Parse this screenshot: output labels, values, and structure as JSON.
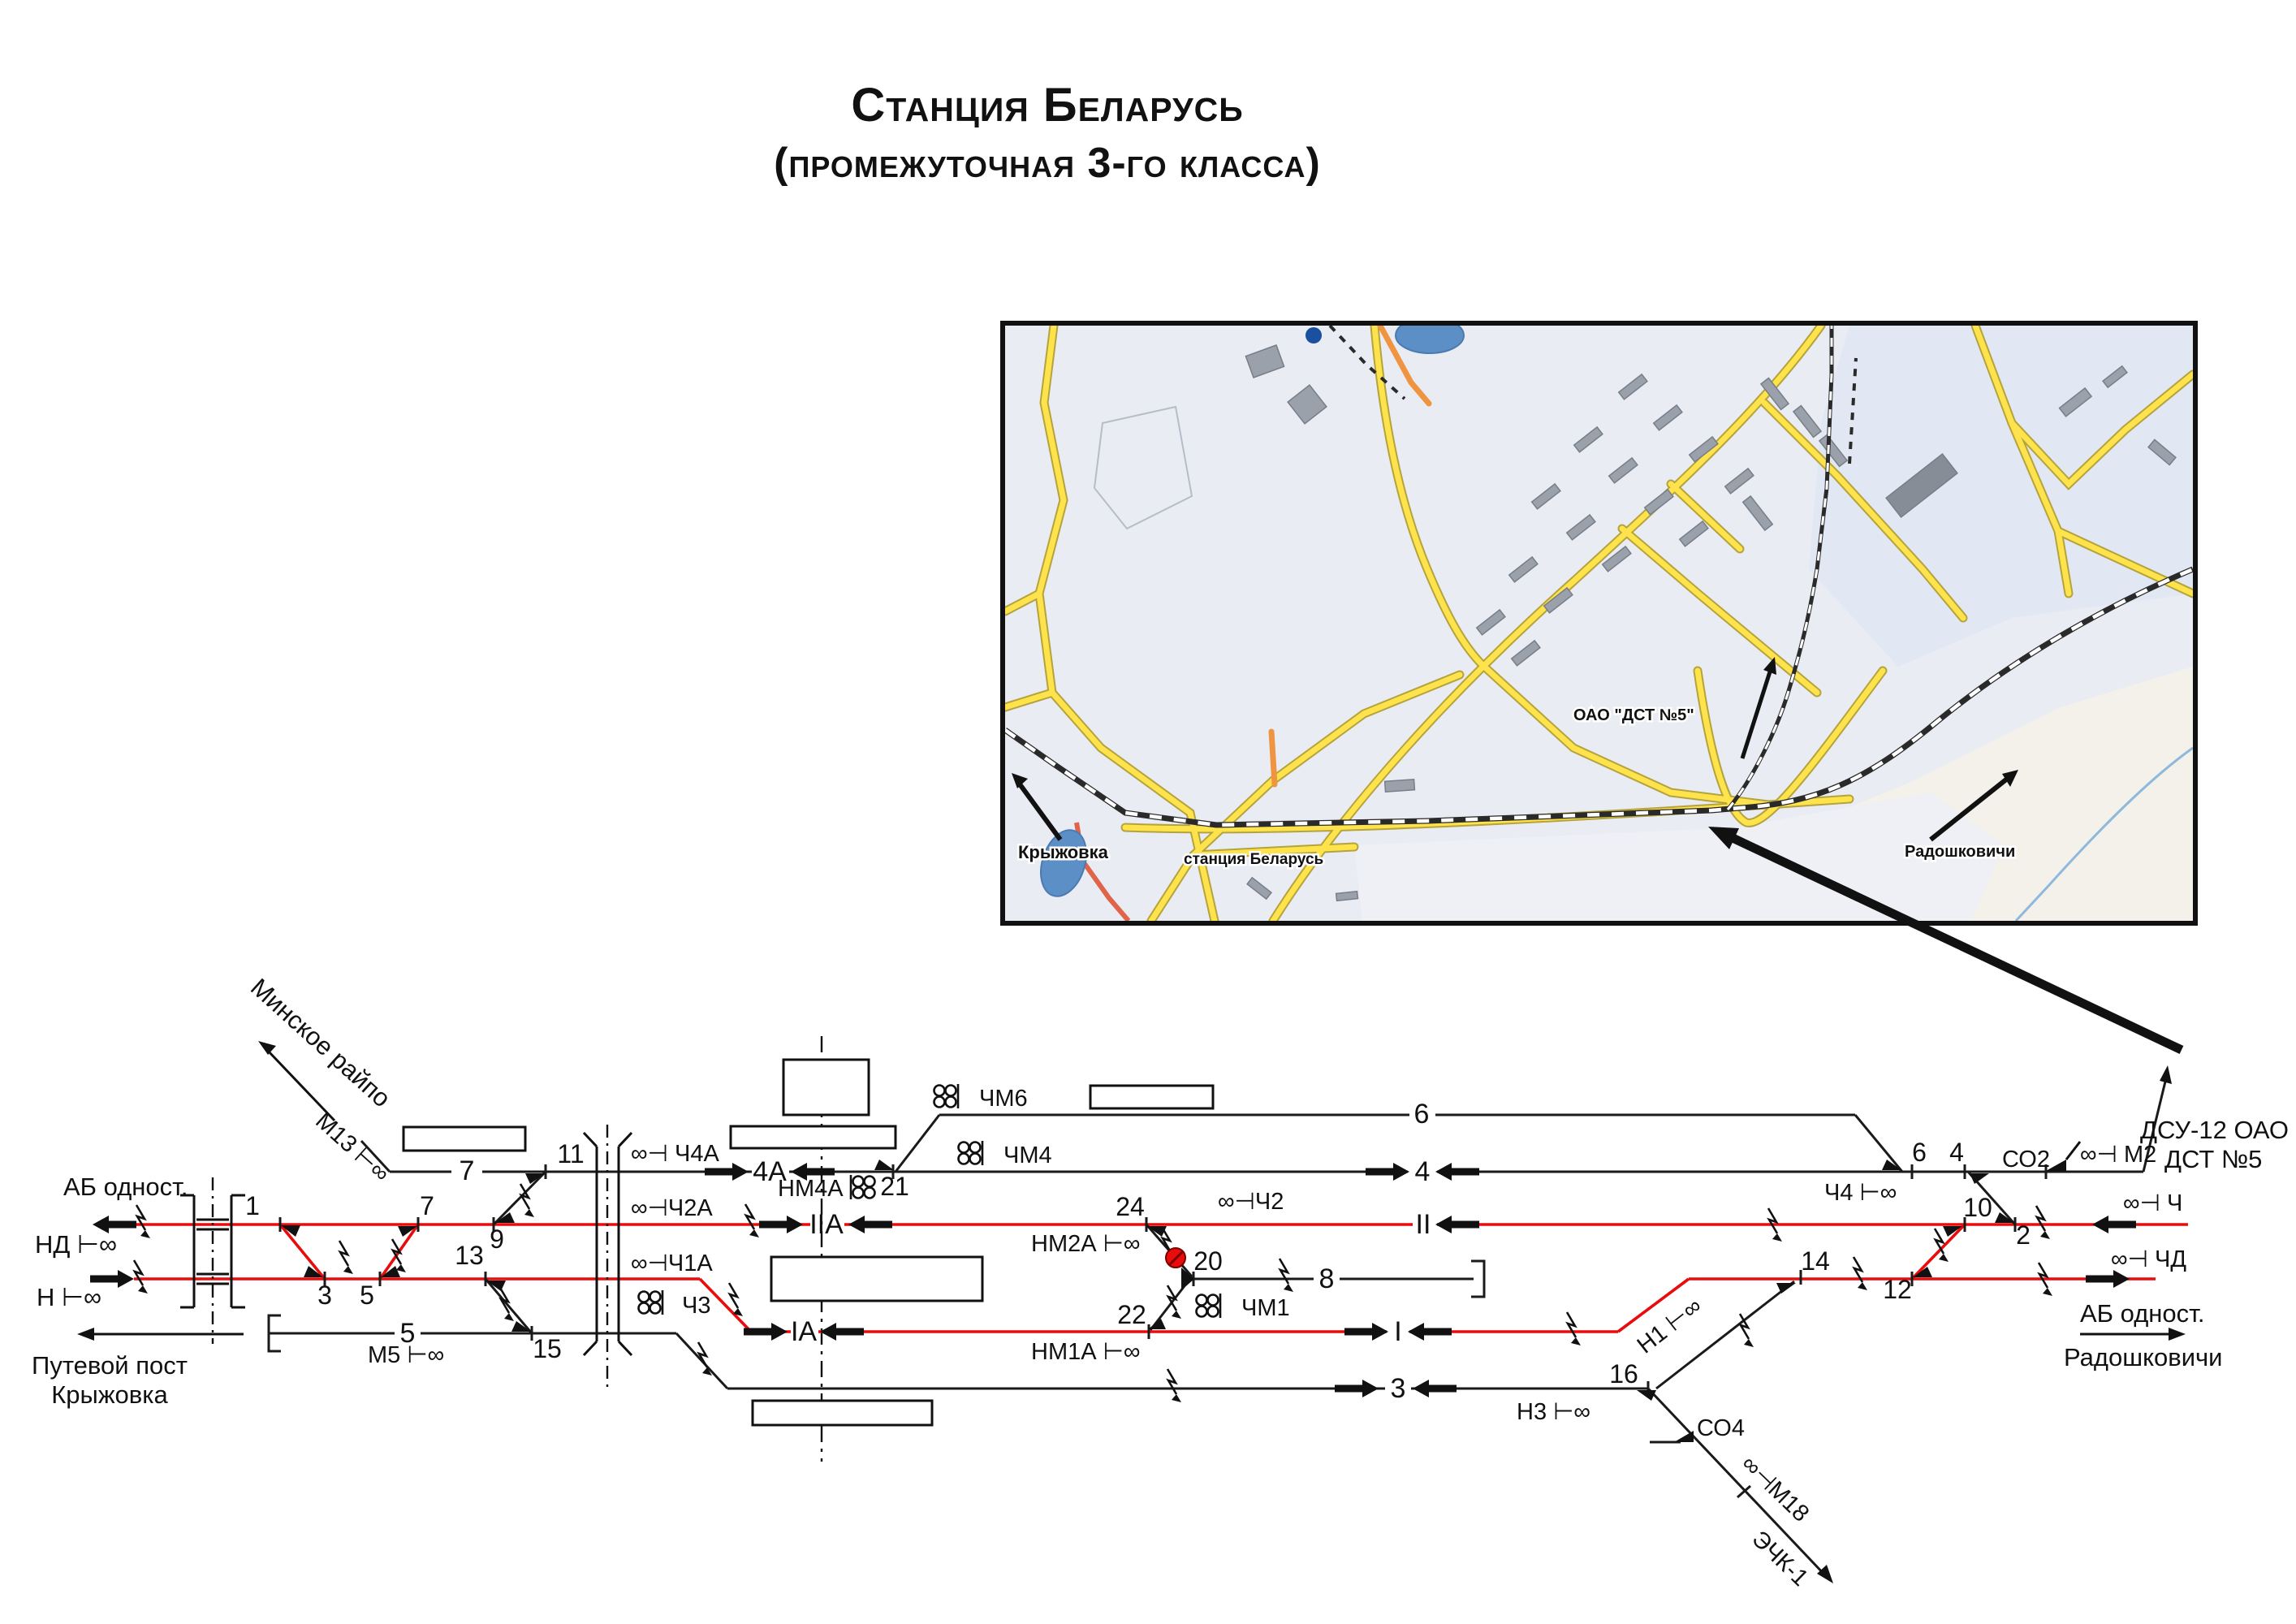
{
  "title": {
    "line1": "Станция Беларусь",
    "line2": "(промежуточная 3-го класса)"
  },
  "map": {
    "labels": {
      "kryzhovka": "Крыжовка",
      "station": "станция Беларусь",
      "dst": "ОАО \"ДСТ №5\"",
      "radoshkovichi": "Радошковичи"
    },
    "colors": {
      "bg": "#e9ecf3",
      "road": "#ffe34d",
      "road_casing": "#b5a33b",
      "orange_road": "#ef9440",
      "red_road": "#e06449",
      "water": "#5d8fc7",
      "building": "#9aa1ab",
      "rail": "#2a2a2a"
    }
  },
  "schematic": {
    "colors": {
      "main_track": "#e80c0c",
      "track": "#1a1a1a"
    },
    "left_labels": {
      "ab": "АБ одност.",
      "nd": "НД ⊢∞",
      "n": "Н ⊢∞",
      "post_line1": "Путевой пост",
      "post_line2": "Крыжовка"
    },
    "right_labels": {
      "ab": "АБ одност.",
      "dest": "Радошковичи",
      "dsu_line1": "ДСУ-12 ОАО",
      "dsu_line2": "ДСТ №5"
    },
    "direction_minsk": "Минское райпо",
    "track_labels": {
      "t7": "7",
      "t5": "5",
      "t4a": "4А",
      "t2a": "IIА",
      "t1a": "IА",
      "t6": "6",
      "t4": "4",
      "t2": "II",
      "t8": "8",
      "t1": "I",
      "t3": "3"
    },
    "turnouts": [
      "1",
      "3",
      "5",
      "7",
      "9",
      "11",
      "13",
      "15",
      "21",
      "24",
      "20",
      "22",
      "16",
      "14",
      "12",
      "10",
      "2",
      "4",
      "6"
    ],
    "signals": {
      "m13": "М13 ⊢∞",
      "m5": "М5 ⊢∞",
      "ch4a": "∞⊣ Ч4А",
      "ch2a": "∞⊣Ч2А",
      "ch1a": "∞⊣Ч1А",
      "ch3": "Ч3",
      "nm4a": "НМ4А",
      "chm6": "ЧМ6",
      "chm4": "ЧМ4",
      "chm1": "ЧМ1",
      "ch2": "∞⊣Ч2",
      "nm2a": "НМ2А ⊢∞",
      "nm1a": "НМ1А ⊢∞",
      "n1": "Н1 ⊢∞",
      "n3": "Н3 ⊢∞",
      "ch4": "Ч4 ⊢∞",
      "so2": "СО2",
      "m2": "∞⊣ М2",
      "ch": "∞⊣ Ч",
      "chd": "∞⊣ ЧД",
      "so4": "СО4",
      "m18": "∞⊣М18",
      "echk": "ЭЧК-1"
    },
    "icons": {
      "dwarf_signal": "two-circle ground signal (∞ with mast bar)",
      "shunt_signal": "four-circle shunting signal",
      "turnout_marker": "filled triangle at switch",
      "bond_arrow": "zigzag traction-bond arrow",
      "red_dot": "red spot marker on crossover 24-20"
    }
  }
}
